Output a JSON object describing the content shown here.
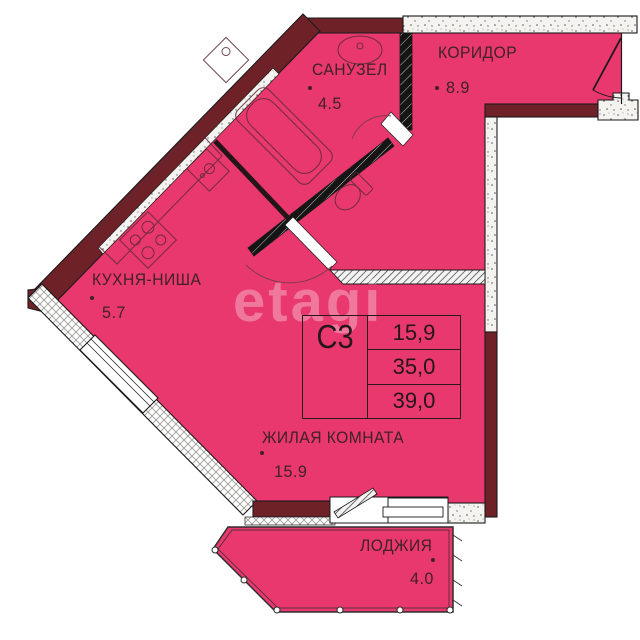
{
  "plan": {
    "watermark": "etagi",
    "rooms": [
      {
        "name": "САНУЗЕЛ",
        "area": "4.5"
      },
      {
        "name": "КОРИДОР",
        "area": "8.9"
      },
      {
        "name": "КУХНЯ-НИША",
        "area": "5.7"
      },
      {
        "name": "ЖИЛАЯ КОМНАТА",
        "area": "15.9"
      },
      {
        "name": "ЛОДЖИЯ",
        "area": "4.0"
      }
    ],
    "info_box": {
      "unit_label": "С3",
      "living_area": "15,9",
      "apartment_area": "35,0",
      "total_area": "39,0"
    },
    "colors": {
      "room_fill": "#e8386d",
      "wall_dark": "#6e2227",
      "outline": "#1a1a1a",
      "label_text": "#3f2227",
      "watermark": "rgba(255,255,255,0.32)"
    }
  }
}
